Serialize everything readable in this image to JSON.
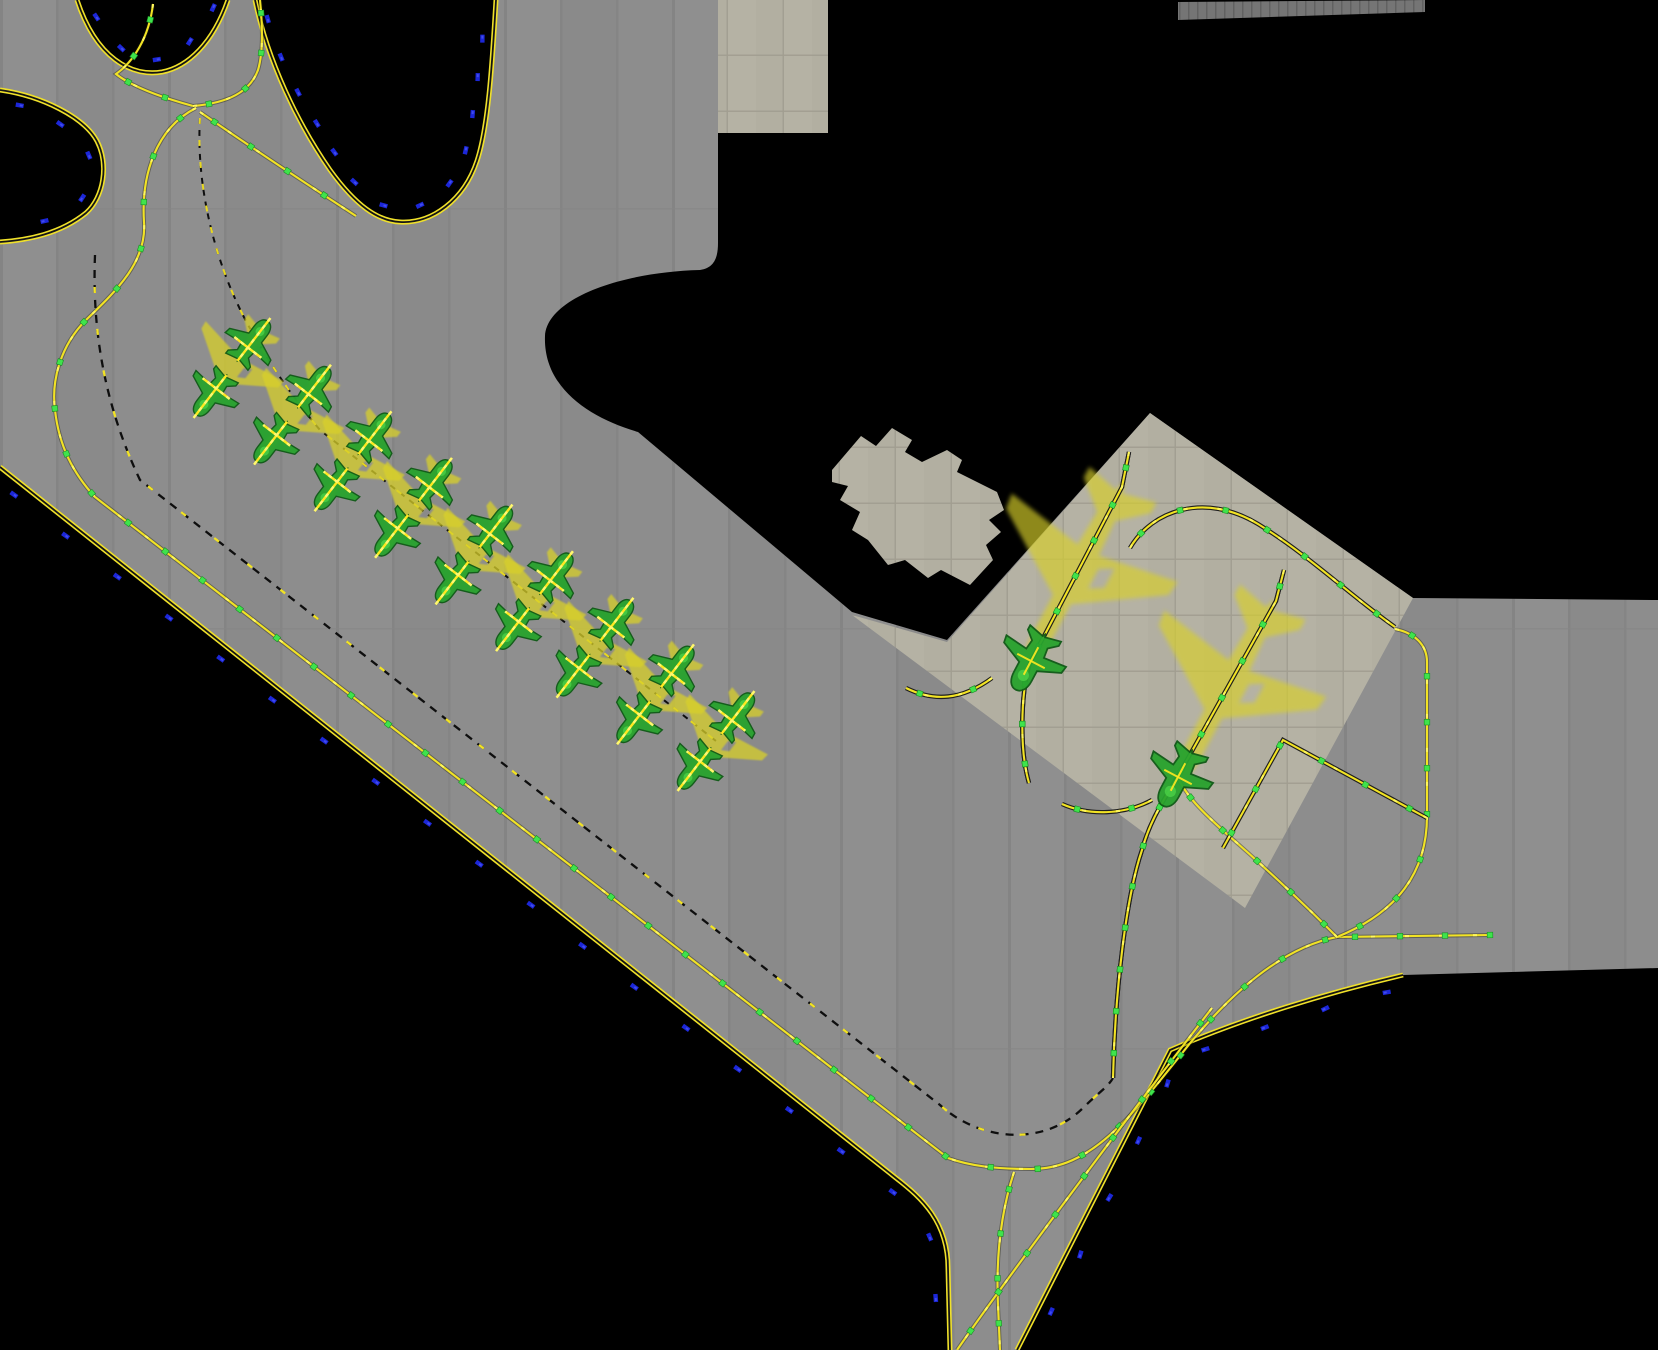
{
  "scene": {
    "width": 1658,
    "height": 1350,
    "colors": {
      "bg": "#000000",
      "tarmac": "#8e8e8e",
      "apron": "#b2afa1",
      "terminal": "#b7b4a5",
      "building": "#b5b2a3",
      "strip": "#757575",
      "edge_yellow": "#f0e12a",
      "edge_gap": "#141414",
      "line_yellow": "#f2e324",
      "line_casing": "rgba(30,30,10,0.40)",
      "apron_casing": "#1e1e1e",
      "line_sparkle": "#fff75e",
      "dash_black": "#0e0e0e",
      "dash_lead_yellow": "#e8d81f",
      "dot_green": "#3fe34c",
      "dot_stroke": "#1b8f25",
      "blue_light": "#1c27d8",
      "blue_light_hi": "#4a55f2",
      "jet_fill": "#d8d02c",
      "green_fill": "#28a32e",
      "green_stroke": "#0f5a16",
      "green_hi": "#4ed44a",
      "cross_yellow": "#ffe920",
      "cross_hi": "#fff871"
    },
    "regions": [
      {
        "name": "pavement-main",
        "fill": "pattern:slab",
        "d": "M0,0 L1658,0 L1658,968 L1403,975 C1330,992 1243,1018 1170,1050 L1017,1350 L950,1350 L948,1268 C948,1222 922,1198 896,1178 L0,467 Z"
      },
      {
        "name": "unpaved-top-right",
        "fill": "color:bg",
        "d": "M718,0 L1658,0 L1658,600 L1413,598 L1150,413 L947,640 L852,612 L638,432 C590,418 543,388 545,336 C547,298 622,272 700,270 C714,268 718,258 718,243 Z"
      },
      {
        "name": "unpaved-island",
        "fill": "color:bg",
        "d": "M255,0 C268,62 298,124 330,170 C356,206 378,221 400,222 C432,224 464,200 477,161 C488,128 492,68 496,0 Z"
      },
      {
        "name": "unpaved-notch-top-left",
        "fill": "color:bg",
        "d": "M77,0 L228,0 C213,43 188,67 162,72 C131,77 96,58 77,0 Z"
      },
      {
        "name": "unpaved-lens-left",
        "fill": "color:bg",
        "d": "M0,90 C42,96 84,117 97,141 C109,164 104,197 86,213 C60,234 28,240 0,242 Z"
      },
      {
        "name": "apron-stands",
        "fill": "pattern:grid",
        "d": "M852,615 L947,642 L1150,413 L1413,598 L1245,908 Z"
      },
      {
        "name": "terminal-pad",
        "fill": "pattern:grid",
        "d": "M718,0 L828,0 L828,133 L718,133 Z"
      },
      {
        "name": "terminal-building",
        "fill": "pattern:grid",
        "d": "M832,470 L861,436 L876,446 L892,428 L912,440 L905,452 L922,462 L947,450 L962,460 L957,472 L997,492 L1004,510 L989,520 L1001,532 L986,545 L993,560 L970,585 L941,570 L928,578 L905,560 L888,565 L868,540 L852,530 L860,512 L840,500 L848,486 L832,482 Z"
      },
      {
        "name": "pavement-strip-top-right",
        "fill": "pattern:tick",
        "d": "M1178,2 L1425,0 L1425,12 L1178,20 Z"
      }
    ],
    "taxi_lines": [
      {
        "id": "island-edge",
        "style": "edge",
        "d": "M255,0 C268,62 298,124 330,170 C356,206 378,221 400,222 C432,224 464,200 477,161 C488,128 492,68 496,0"
      },
      {
        "id": "notch-edge",
        "style": "edge",
        "d": "M77,0 C96,58 131,77 162,72 C188,67 213,43 228,0"
      },
      {
        "id": "lens-edge",
        "style": "edge",
        "d": "M0,90 C42,96 84,117 97,141 C109,164 104,197 86,213 C60,234 28,240 0,242"
      },
      {
        "id": "sw-edge",
        "style": "edge",
        "d": "M0,467 L896,1178 C922,1198 948,1222 948,1268 L950,1350"
      },
      {
        "id": "se-edge",
        "style": "edge",
        "d": "M1403,975 C1330,992 1243,1018 1170,1050 L1017,1350"
      },
      {
        "id": "c-top-in",
        "style": "center",
        "dots": 40,
        "d": "M153,4 C149,38 133,62 116,74 C131,86 160,97 193,106"
      },
      {
        "id": "c-top-up",
        "style": "center",
        "dots": 40,
        "d": "M193,106 C228,103 250,92 258,70 C264,50 262,20 260,0"
      },
      {
        "id": "c-island-stub",
        "style": "center",
        "dots": 44,
        "d": "M200,112 C245,143 305,183 356,216"
      },
      {
        "id": "c-sw-long",
        "style": "center",
        "dots": 47,
        "d": "M196,108 C156,128 141,175 144,222 C147,262 116,291 86,320 C61,345 51,380 55,410 C59,446 73,473 95,497 L948,1158 C970,1166 996,1169 1031,1169 C1091,1169 1129,1120 1191,1042 C1251,970 1300,944 1337,937"
      },
      {
        "id": "c-south",
        "style": "center",
        "dots": 45,
        "d": "M1014,1172 C1000,1215 996,1262 998,1305 L1000,1350"
      },
      {
        "id": "c-south-diag",
        "style": "center",
        "dots": 48,
        "d": "M1212,1008 C1110,1140 1000,1288 957,1350"
      },
      {
        "id": "c-east",
        "style": "center",
        "dots": 45,
        "d": "M1337,937 L1490,935"
      },
      {
        "id": "c-right-vert",
        "style": "center",
        "dots": 46,
        "d": "M1395,629 C1415,633 1427,645 1427,662 L1427,816 C1427,872 1398,912 1337,937"
      },
      {
        "id": "c-to-stand2",
        "style": "center",
        "dots": 46,
        "d": "M1337,937 C1290,890 1252,856 1228,835 C1200,810 1186,795 1178,778"
      },
      {
        "id": "c-diamond",
        "style": "centerA",
        "dots": 50,
        "d": "M1427,818 L1283,740 L1223,848"
      },
      {
        "id": "arc-apron",
        "style": "centerA",
        "dots": 46,
        "d": "M1130,548 C1152,510 1205,492 1258,524 C1310,556 1352,597 1395,627"
      },
      {
        "id": "stand1-lead",
        "style": "centerA",
        "dots": 40,
        "above": true,
        "d": "M1129,452 L1122,487 L1031,661 C1022,680 1018,745 1029,783"
      },
      {
        "id": "stand1-west",
        "style": "centerA",
        "dots": 55,
        "d": "M992,678 C962,700 934,702 906,688"
      },
      {
        "id": "stand2-lead",
        "style": "centerA",
        "dots": 42,
        "above": true,
        "d": "M1284,570 L1276,601 L1178,776 C1164,800 1150,820 1142,850 C1126,897 1115,992 1113,1078"
      },
      {
        "id": "stand2-west",
        "style": "centerA",
        "dots": 55,
        "d": "M1152,800 C1124,815 1089,816 1062,804"
      },
      {
        "id": "dash-mid",
        "style": "dashb",
        "d": "M95,255 C92,330 104,404 140,480 L940,1105 C978,1140 1042,1148 1083,1108 C1098,1093 1108,1087 1113,1078"
      },
      {
        "id": "dash-row",
        "style": "dashlead",
        "d": "M200,118 C196,180 212,262 252,332 C268,360 288,392 320,430 L716,741"
      }
    ],
    "blue_chains": [
      {
        "ref": "sw-edge",
        "offset": -13,
        "interval": 66,
        "phase": 28
      },
      {
        "ref": "se-edge",
        "offset": 13,
        "interval": 64,
        "phase": 20
      },
      {
        "ref": "island-edge",
        "toward": [
          372,
          110
        ],
        "offset": 14,
        "interval": 42,
        "phase": 10
      },
      {
        "ref": "notch-edge",
        "toward": [
          152,
          18
        ],
        "offset": 13,
        "interval": 50,
        "phase": 18
      },
      {
        "ref": "lens-edge",
        "toward": [
          38,
          163
        ],
        "offset": 13,
        "interval": 55,
        "phase": 16
      }
    ],
    "aircraft": {
      "row": {
        "start": [
          232,
          368
        ],
        "end": [
          716,
          741
        ],
        "stations": 9,
        "green_offset": 33,
        "jet_scale": 1.05,
        "green_scale": 1.0
      },
      "big_jets": [
        {
          "name": "aircraft-stand-1",
          "x": 1076,
          "y": 573,
          "rot": 208,
          "scale": 2.0
        },
        {
          "name": "aircraft-stand-2",
          "x": 1227,
          "y": 688,
          "rot": 208,
          "scale": 1.95
        }
      ],
      "stand_icons": [
        {
          "name": "stand-marker-1",
          "x": 1031,
          "y": 661,
          "rot": 208,
          "scale": 1.25
        },
        {
          "name": "stand-marker-2",
          "x": 1178,
          "y": 777,
          "rot": 208,
          "scale": 1.25
        }
      ]
    },
    "sprites": {
      "jet": "M0,-52 C3,-51 5,-46 5,-38 L5,-15 L46,12 L47,20 L6,13 L5,32 L19,44 L19,50 L2,46 L0,52 L-2,46 L-19,50 L-19,44 L-5,32 L-6,13 L-47,20 L-46,12 L-5,-15 L-5,-38 C-5,-46 -3,-51 0,-52 Z M9,-4 L16,0 L16,11 L9,7 Z M-9,-4 L-16,0 L-16,11 L-9,7 Z",
      "small": "M0,-26 C5,-26 8,-21 8,-14 L8,-5 L26,3 L27,9 L8,7 L7,15 L14,21 L14,25 L1,22 L0,24 L-1,22 L-14,25 L-14,21 L-7,15 L-8,7 L-27,9 L-26,3 L-8,-5 L-8,-14 C-8,-21 -5,-26 0,-26 Z"
    }
  }
}
